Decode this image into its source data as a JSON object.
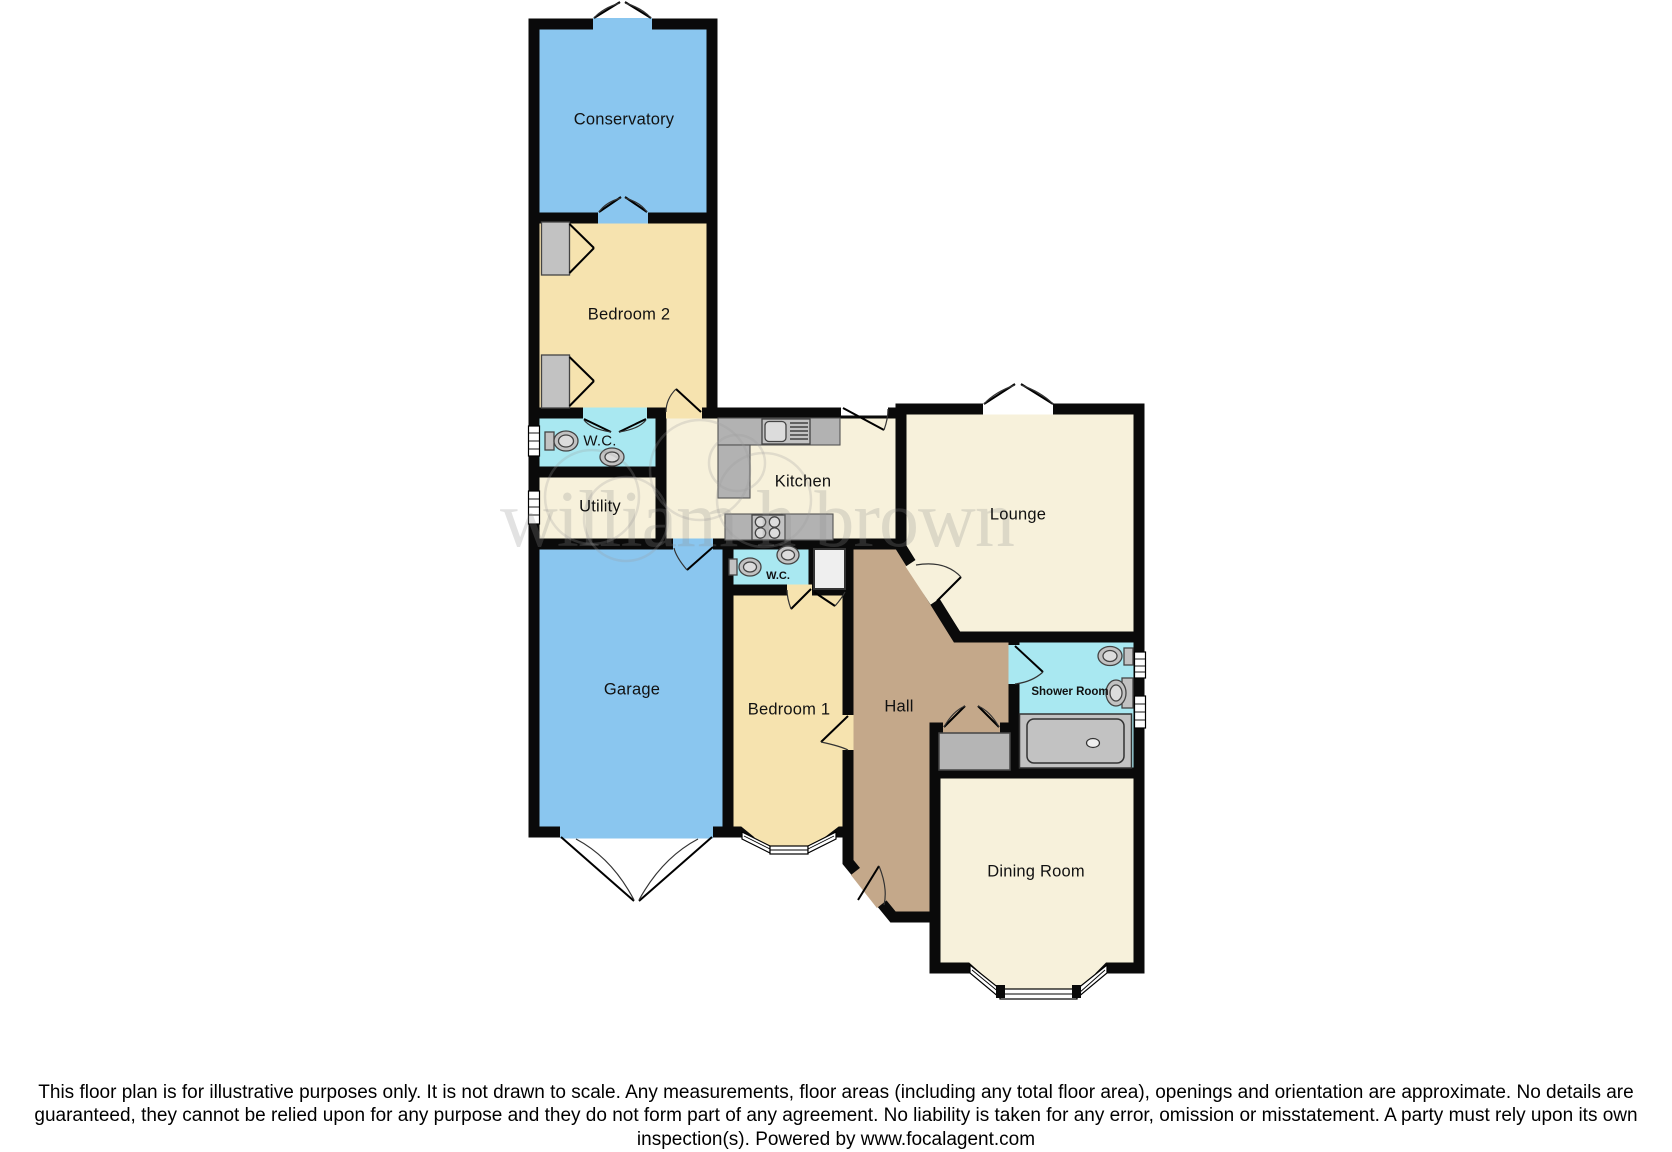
{
  "plan": {
    "rooms": [
      {
        "id": "conservatory",
        "label": "Conservatory"
      },
      {
        "id": "bedroom2",
        "label": "Bedroom 2"
      },
      {
        "id": "wc-upper",
        "label": "W.C."
      },
      {
        "id": "utility",
        "label": "Utility"
      },
      {
        "id": "kitchen",
        "label": "Kitchen"
      },
      {
        "id": "lounge",
        "label": "Lounge"
      },
      {
        "id": "garage",
        "label": "Garage"
      },
      {
        "id": "wc-lower",
        "label": "W.C."
      },
      {
        "id": "bedroom1",
        "label": "Bedroom 1"
      },
      {
        "id": "hall",
        "label": "Hall"
      },
      {
        "id": "shower-room",
        "label": "Shower Room"
      },
      {
        "id": "dining-room",
        "label": "Dining Room"
      }
    ],
    "watermark": "william h brown",
    "colors": {
      "wall": "#0a0a0a",
      "blue_room": "#8AC6EF",
      "bedroom_tan": "#F6E3AF",
      "living_cream": "#F7F1DB",
      "wet_room_cyan": "#A9E8F1",
      "hall_brown": "#C4A88A",
      "fixture_gray": "#c2c2c2"
    }
  },
  "footer": {
    "disclaimer": "This floor plan is for illustrative purposes only. It is not drawn to scale. Any measurements, floor areas (including any total floor area), openings and orientation are approximate. No details are guaranteed, they cannot be relied upon for any purpose and they do not form part of any agreement. No liability is taken for any error, omission or misstatement. A party must rely upon its own inspection(s). Powered by www.focalagent.com"
  }
}
